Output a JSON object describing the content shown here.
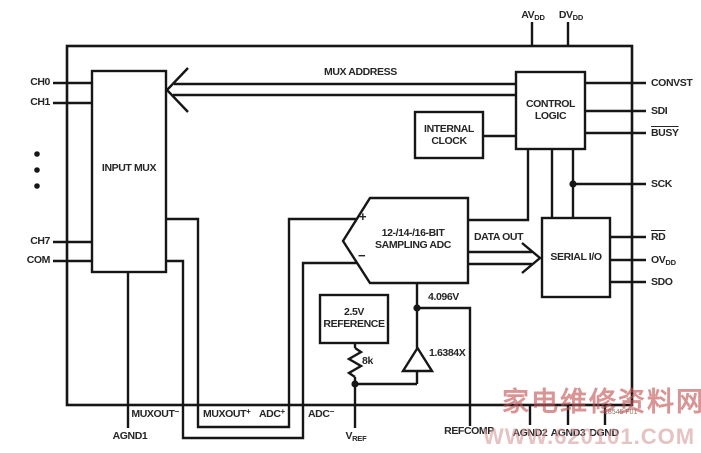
{
  "blocks": {
    "input_mux": {
      "label": "INPUT MUX"
    },
    "internal_clock": {
      "line1": "INTERNAL",
      "line2": "CLOCK"
    },
    "control_logic": {
      "line1": "CONTROL",
      "line2": "LOGIC"
    },
    "serial_io": {
      "label": "SERIAL I/O"
    },
    "adc": {
      "line1": "12-/14-/16-BIT",
      "line2": "SAMPLING ADC",
      "plus": "+",
      "minus": "−"
    },
    "reference": {
      "line1": "2.5V",
      "line2": "REFERENCE"
    },
    "amplifier": {
      "gain": "1.6384X"
    },
    "resistor": {
      "value": "8k"
    }
  },
  "signals": {
    "mux_address": "MUX ADDRESS",
    "data_out": "DATA OUT",
    "ref_voltage": "4.096V"
  },
  "pins": {
    "left": [
      {
        "name": "CH0"
      },
      {
        "name": "CH1"
      },
      {
        "name": "CH7"
      },
      {
        "name": "COM"
      }
    ],
    "top": [
      {
        "base": "AV",
        "sub": "DD"
      },
      {
        "base": "DV",
        "sub": "DD"
      }
    ],
    "right": [
      {
        "name": "CONVST"
      },
      {
        "name": "SDI"
      },
      {
        "name": "BUSY"
      },
      {
        "name": "SCK"
      },
      {
        "name": "RD"
      },
      {
        "base": "OV",
        "sub": "DD"
      },
      {
        "name": "SDO"
      }
    ],
    "bottom": [
      {
        "name": "AGND1"
      },
      {
        "base": "MUXOUT",
        "sup": "−"
      },
      {
        "base": "MUXOUT",
        "sup": "+"
      },
      {
        "base": "ADC",
        "sup": "+"
      },
      {
        "base": "ADC",
        "sup": "−"
      },
      {
        "base": "V",
        "sub": "REF"
      },
      {
        "name": "REFCOMP"
      },
      {
        "name": "AGND2"
      },
      {
        "name": "AGND3"
      },
      {
        "name": "DGND"
      }
    ]
  },
  "annotations": {
    "fig_number": "18545 F01"
  },
  "watermark": {
    "chinese": "家电维修资料网",
    "url": "WWW.620101.COM",
    "color_chinese": "#c25555",
    "color_url": "#d79a9a"
  },
  "colors": {
    "line": "#161616",
    "text": "#262626",
    "background": "#ffffff"
  }
}
